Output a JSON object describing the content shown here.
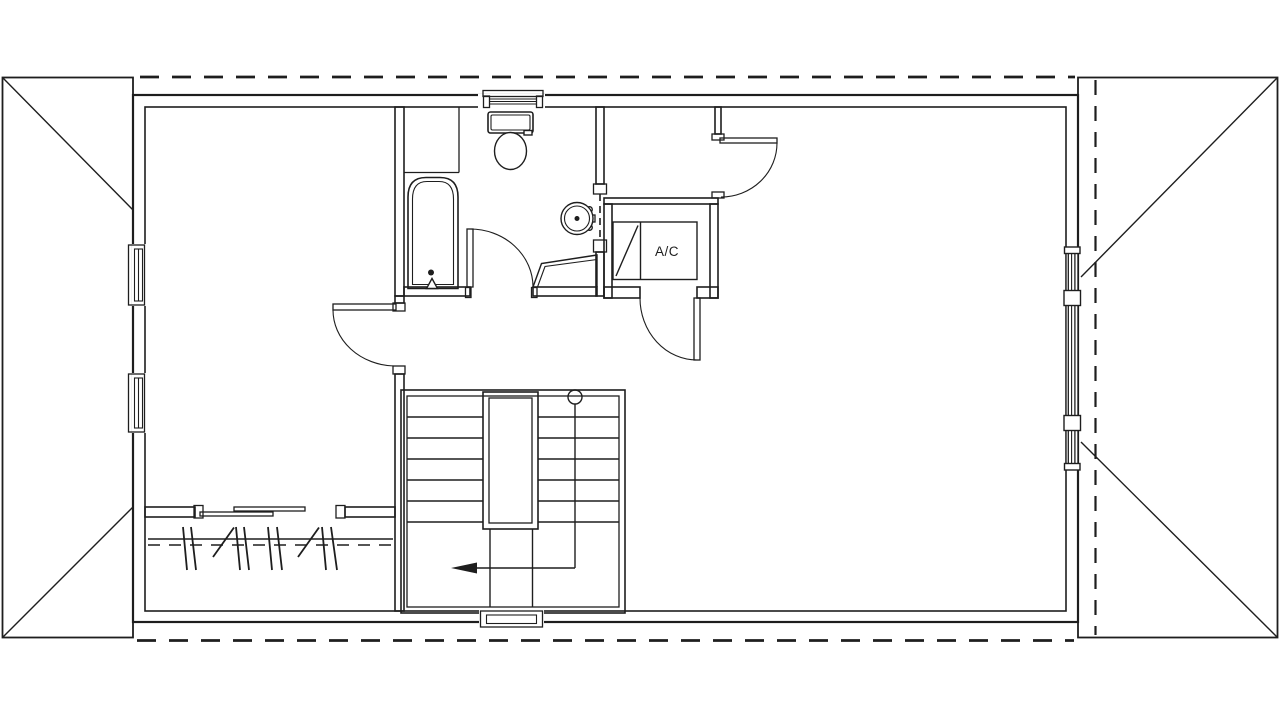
{
  "app": {
    "drawing_type": "architectural-floor-plan",
    "background_color": "#ffffff",
    "line_color": "#1e1e1e"
  },
  "labels": {
    "ac_unit": "A/C"
  },
  "icons": {
    "stair_direction_arrow": "left-arrow",
    "stair_start_marker": "circle",
    "fixture_symbols": [
      "bathtub",
      "toilet",
      "sink",
      "corner-bench",
      "closet-rod-with-hangers",
      "sliding-closet-doors",
      "ac-unit",
      "switchback-stairs",
      "double-hung-windows",
      "door-swing-arcs",
      "roof-gable-hips",
      "roof-overhang-dashed-lines",
      "pocket-door"
    ]
  }
}
